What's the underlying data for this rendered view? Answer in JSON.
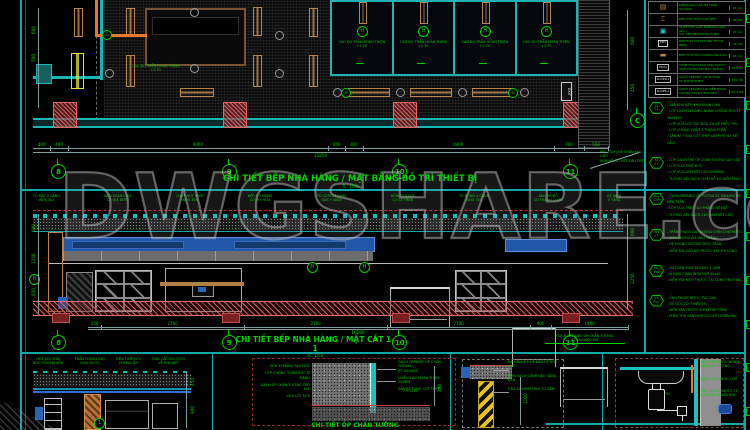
{
  "watermark": {
    "text": "DWGSHARE.com"
  },
  "colors": {
    "annotation_green": "#00d200",
    "wall_cyan": "#18b6b6",
    "column_red": "#cc4444",
    "fixture_tan": "#b8864b",
    "equipment_blue": "#2b63b8",
    "floor_hatch_red": "#c04040",
    "background": "#000000"
  },
  "plan": {
    "title": "CHI TIẾT BẾP NHÀ HÀNG / MẶT BẰNG BỐ TRÍ THIẾT BỊ",
    "scale": "TL: 1/50",
    "exit_label": "EXIT",
    "ceiling_note": "CAO ĐỘ TRẦN HOÀN THIỆN\n+2.70",
    "stalls": [
      {
        "tag": "H",
        "label": "CAO ĐỘ TRẦN HOÀN THIỆN\n+2.70"
      },
      {
        "tag": "H",
        "label": "CAO ĐỘ TRẦN HOÀN THIỆN\n+2.70"
      },
      {
        "tag": "H",
        "label": "CAO ĐỘ TRẦN HOÀN THIỆN\n+2.70"
      },
      {
        "tag": "H",
        "label": "CAO ĐỘ TRẦN HOÀN THIỆN\n+2.70"
      }
    ],
    "grid_bubbles": [
      "8",
      "9",
      "10",
      "11"
    ],
    "side_bubble": "C",
    "dims_left": [
      "600",
      "500"
    ],
    "dims_right": [
      "600",
      "450"
    ],
    "dims_bottom": [
      "400",
      "400",
      "6000",
      "400",
      "400",
      "4400",
      "700",
      "550"
    ],
    "dims_total": "13250"
  },
  "section": {
    "title": "CHI TIẾT BẾP NHÀ HÀNG / MẶT CẮT 1-1",
    "scale": "TL: 1/50",
    "equipment_labels": [
      "TỦ MÁT 2 CÁNH\nINOX 304",
      "BÀN SOẠN CHIA\nCÓ GIÁ DƯỚI",
      "CHỤP HÚT KHÓI\nINOX 304",
      "BẾP Á 2 HỌNG\nCÓ VÒI RỬA",
      "TỦ CƠM 24 KHAY\nGAS + ĐIỆN",
      "BỒN RỬA ĐÔI\nCÓ KỆ TRÊN",
      "TỦ ĐÔNG 4 CÁNH\nINOX 304",
      "BÀN RA ĐỒ\nCÓ THÀNH CHẮN",
      "KỆ INOX\n4 TẦNG"
    ],
    "grid_bubbles": [
      "8",
      "9",
      "10",
      "11"
    ],
    "roof_note": "MÁI TÔN CHE CHẮN KHU GIẶT\nXEM HỒ SƠ KẾT CẤU THÉP",
    "right_note": "GẠCH CERAMIC ỐP CHÂN TƯỜNG\nKT 100x600 MM",
    "marker_tag": "H",
    "dims_left": [
      "600",
      "1350",
      "850"
    ],
    "dims_right": [
      "600",
      "2250"
    ],
    "dims_bottom": [
      "250",
      "2700",
      "2700",
      "2700",
      "400",
      "1450"
    ],
    "dims_total": "10200"
  },
  "legend": {
    "rows": [
      {
        "kind": "tan",
        "sym": "▤",
        "desc": "MIỆNG GIÓ CẤP ÂM TRẦN\n600x600",
        "qty": "04 CÁI"
      },
      {
        "kind": "tan",
        "sym": "⌶",
        "desc": "ĐÈN THẢ TRẦN KHU BẾP",
        "qty": "06 CÁI"
      },
      {
        "kind": "dl",
        "sym": "▣",
        "desc": "QUẠT HÚT GẮN TRẦN NỐI ỐNG GIÓ\nCHI TIẾT XEM HỒ SƠ ĐIỆN",
        "qty": "05 CÁI"
      },
      {
        "kind": "exit",
        "sym": "EXIT",
        "desc": "ĐÈN EXIT CHỈ HƯỚNG THOÁT HIỂM",
        "qty": "02 CÁI"
      },
      {
        "kind": "tan",
        "sym": "▬",
        "desc": "ĐÈN TUÝP ĐÔI CHỐNG ẨM 1.2M",
        "qty": "08 CÁI"
      },
      {
        "kind": "tag",
        "sym": "TR-01",
        "desc": "TRẦN THẠCH CAO CHỊU NƯỚC\nSƠN CHỐNG ẨM MÀU TRẮNG",
        "qty": "45.5 M2"
      },
      {
        "kind": "tag",
        "sym": "CL/CER-1",
        "desc": "GẠCH CERAMIC ỐP TƯỜNG\nKT 300x600 MM",
        "qty": "78.0 M2"
      },
      {
        "kind": "tag",
        "sym": "SL/CER-2",
        "desc": "GẠCH CERAMIC LÁT NỀN NHÁM\nCHỐNG TRƯỢT 300x300",
        "qty": "61.4 M2"
      }
    ]
  },
  "notes": {
    "groups": [
      {
        "tag": "S1\nT1",
        "text": "- SÀN KHU BẾP, KHU SOẠN CHIA\n- LỚP GẠCH CERAMIC NHÁM CHỐNG TRƯỢT 300x300\n- LỚP VỮA LÓT TẠO DỐC 1% VỀ PHỄU THU\n- LỚP CHỐNG THẤM 2 THÀNH PHẦN\n- SÀN BÊ TÔNG CỐT THÉP (XEM HỒ SƠ KẾT CẤU)"
      },
      {
        "tag": "S2\nT2",
        "text": "- LỚP GẠCH THẺ ỐP CHÂN TƯỜNG CAO 100\n- LỚP VỮA TRÁT M75\n- LỚP VỮA LIÊN KẾT GỐC XI MĂNG\n- TƯỜNG XÂY GẠCH (XEM HỒ SƠ KIẾN TRÚC)"
      },
      {
        "tag": "W1\nCER",
        "text": "- GẠCH CERAMIC ỐP TƯỜNG KT 300x600 ỐP ĐẾN TRẦN\n- LỚP VỮA TRÁT TẠO PHẲNG BỀ MẶT\n- TƯỜNG XÂY GẠCH 110 (XEM KẾT CẤU)"
      },
      {
        "tag": "KH\nT3",
        "text": "- TRẦN THẠCH CAO KHUNG CHÌM CHỊU NƯỚC\n- SƠN CHỐNG ẨM MÀU TRẮNG\n- HỆ KHUNG XƯƠNG TREO TRẦN\n- KIỂM TRA CAO ĐỘ TRƯỚC KHI THI CÔNG"
      },
      {
        "tag": "M1\nINX",
        "text": "- MẶT BÀN INOX 304 DÀY 1.2MM\n- KHUNG CHÂN INOX HỘP 40x40\n- KIỂM TRA KÍCH THƯỚC TẠI CÔNG TRƯỜNG"
      },
      {
        "tag": "V1\nPVC",
        "text": "- ỐNG THOÁT NƯỚC PVC D90\n- ĐỘ DỐC TỐI THIỂU 1%\n- KIỂM TRA TRƯỚC KHI ĐỔ BÊ TÔNG\n- PHỄU THU SÀN INOX CÓ LƯỚI CHẮN RÁC"
      }
    ]
  },
  "details": {
    "a": {
      "labels_top": [
        "HỘP GIÓ THẢI\nBỌC TÔN MẠ KẼM",
        "TRẦN THẠCH CAO\nCHỊU NƯỚC",
        "ĐÈN TUÝP ĐÔI\nCHỐNG ẨM",
        "ỐNG CẤP GIÓ TƯƠI\nVỀ KHU BẾP"
      ],
      "dims": [
        "450",
        "900"
      ],
      "marker": "1"
    },
    "b": {
      "labels_left": [
        "VỮA XI MĂNG TẠO DỐC",
        "LỚP CHỐNG THẤM GỐC XI MĂNG",
        "GẠCH ỐP CHÂN TƯỜNG CAO 100",
        "VỮA LÓT M75"
      ],
      "labels_right": [
        "GẠCH CERAMIC ỐP CHÂN TƯỜNG\nKT 100x600",
        "CHIỀU CAO HOÀN THIỆN 100MM",
        "SÀN BÊ TÔNG CỐT THÉP"
      ],
      "level": "▽ +0.100",
      "dim": "100",
      "title": "CHI TIẾT ỐP CHÂN TƯỜNG"
    },
    "c": {
      "labels": [
        "ĐÁ GRANITE ỐP BẢO VỆ GÓC CỘT",
        "SƠN VẠCH CẢNH BÁO VÀNG - ĐEN",
        "CAO 1100MM TÍNH TỪ SÀN"
      ],
      "dim": "1100"
    },
    "d": {
      "labels": [
        "ỐNG CẤP NƯỚC NÓNG LẠNH ÂM TƯỜNG",
        "CHẬU RỬA INOX 1 HỐ",
        "ỐNG THOÁT NƯỚC CÓ XI PHÔNG NGĂN MÙI"
      ],
      "dim": "750"
    }
  }
}
